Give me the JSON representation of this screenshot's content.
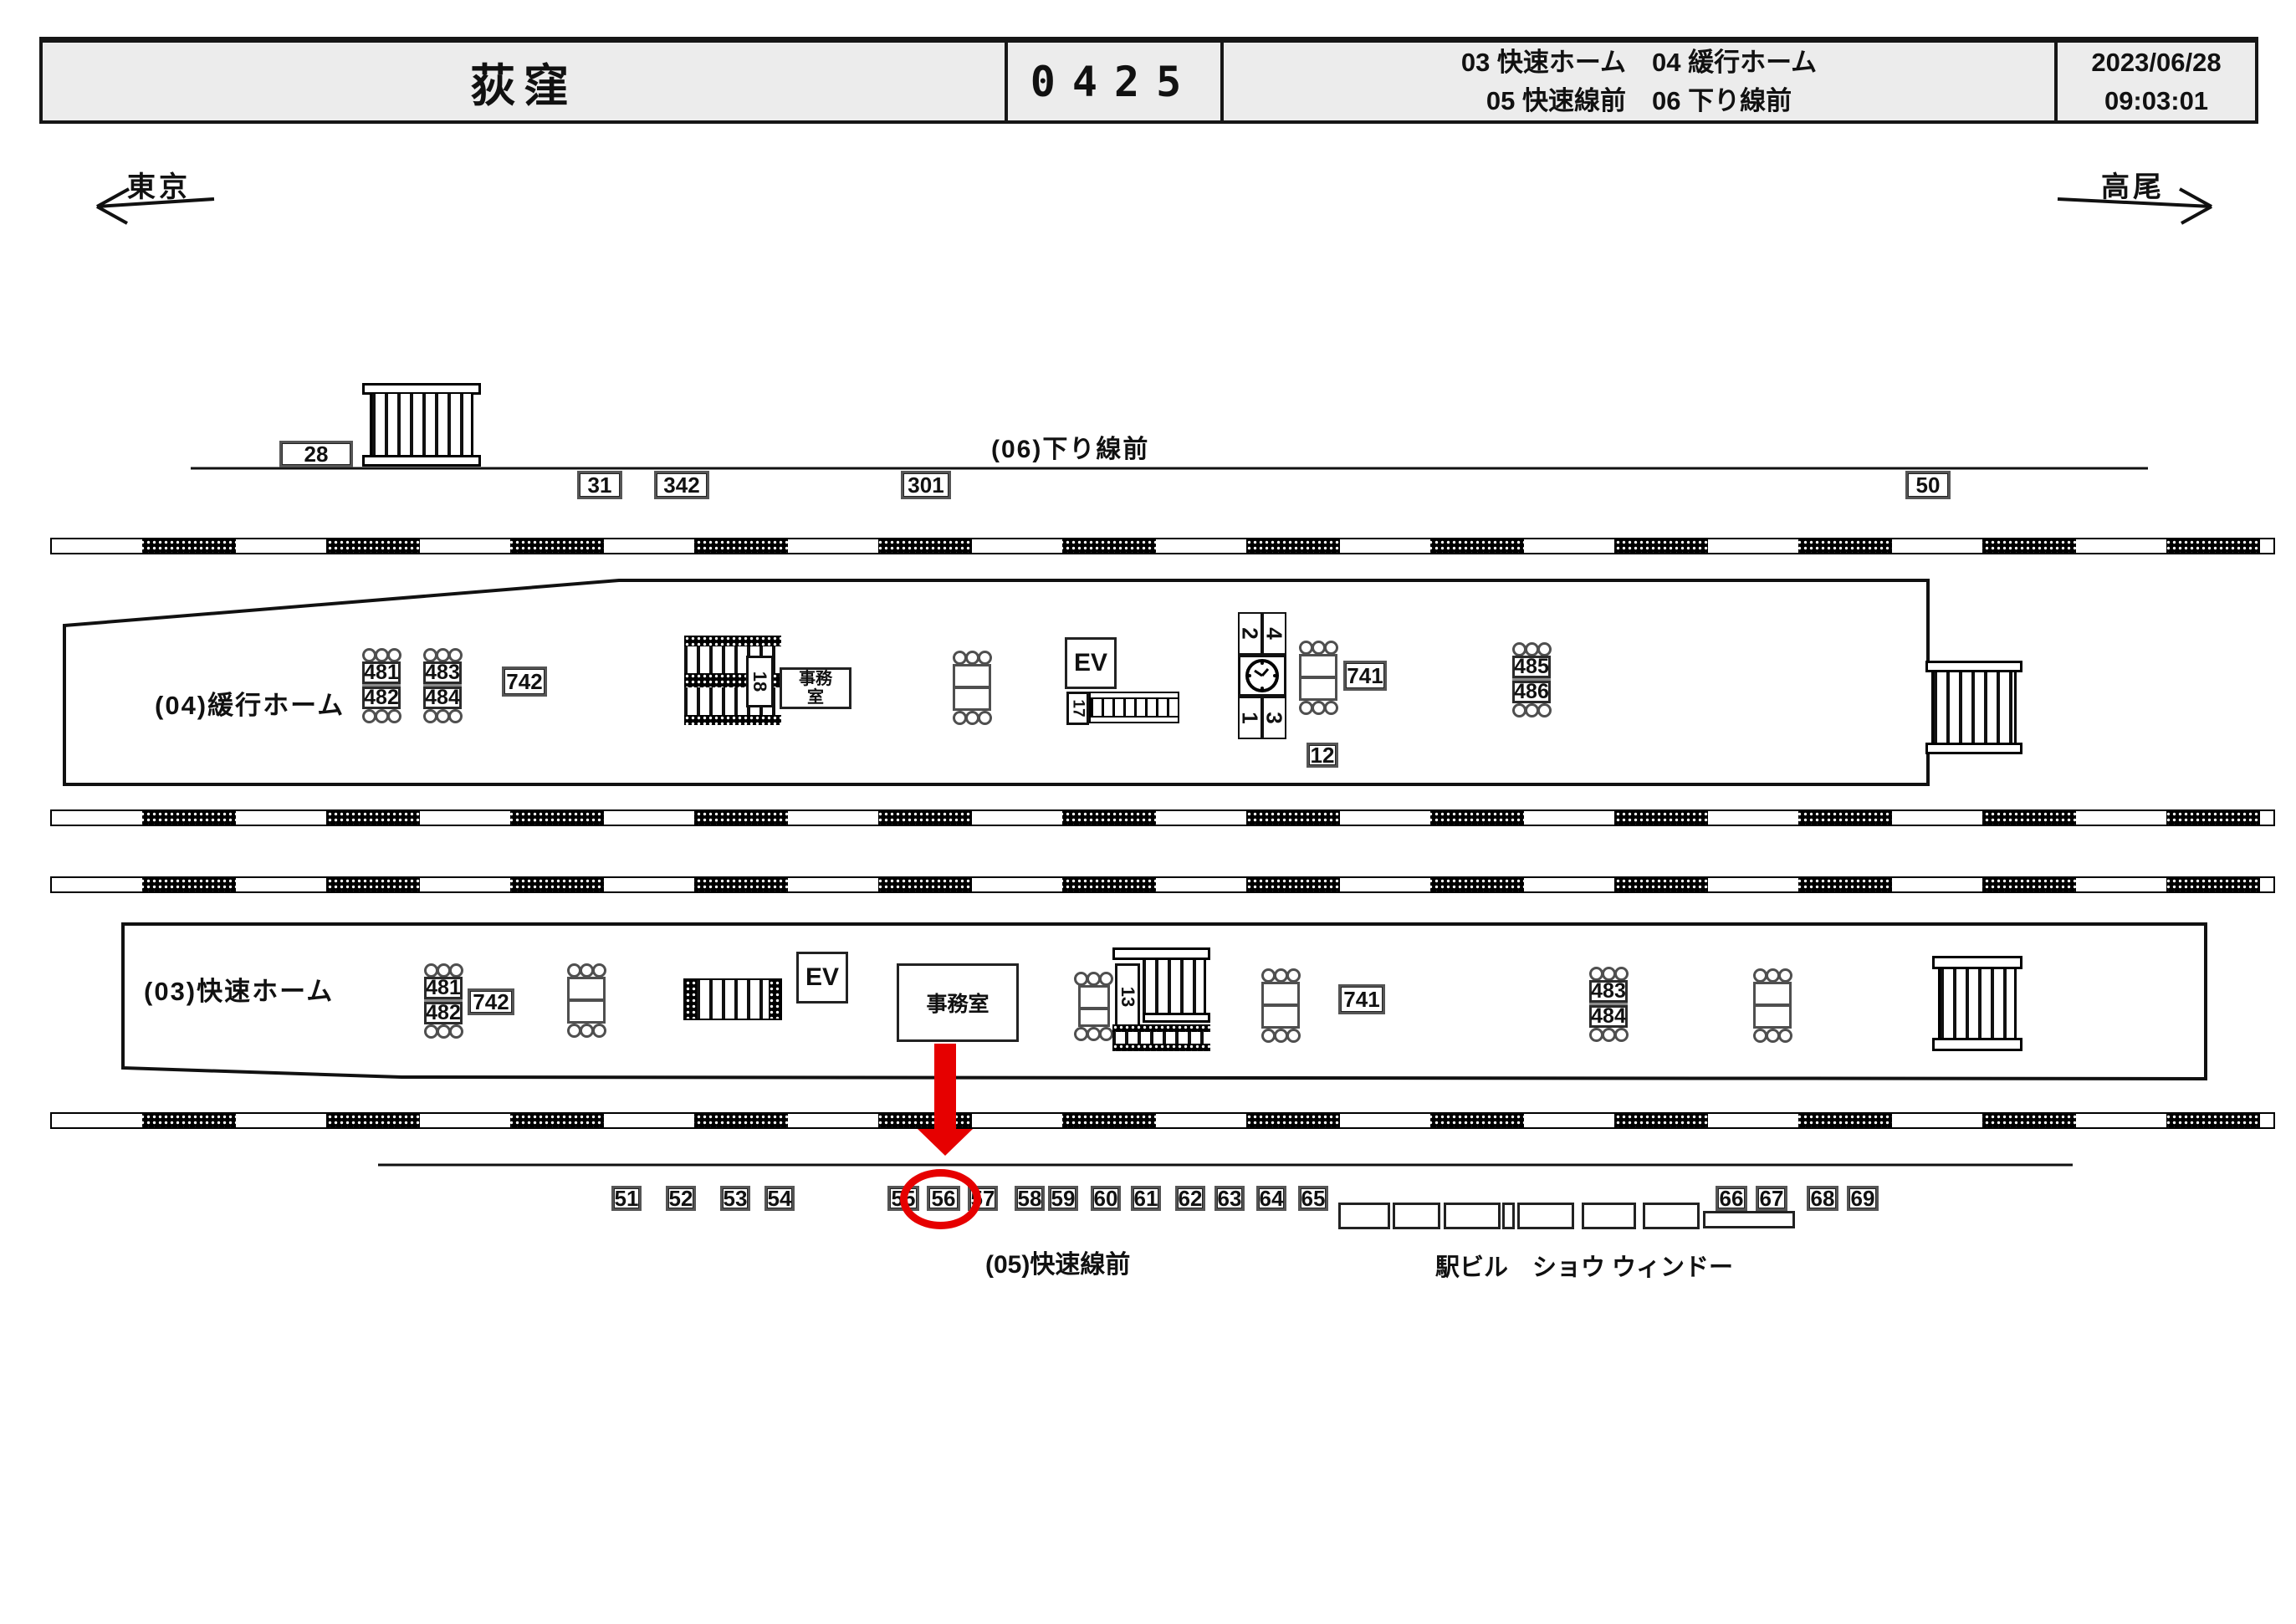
{
  "header": {
    "station_name": "荻窪",
    "station_code": "0425",
    "platform_list_1": "03 快速ホーム　04 緩行ホーム",
    "platform_list_2": "05 快速線前　06 下り線前",
    "date": "2023/06/28",
    "time": "09:03:01"
  },
  "directions": {
    "left": "東京",
    "right": "高尾"
  },
  "line06": {
    "label": "(06)下り線前",
    "box_28": "28",
    "boxes_below": [
      "31",
      "342",
      "301",
      "50"
    ]
  },
  "platform04": {
    "label": "(04)緩行ホーム",
    "benchA": [
      "481",
      "482"
    ],
    "benchB": [
      "483",
      "484"
    ],
    "benchC": [
      "485",
      "486"
    ],
    "box742": "742",
    "box741": "741",
    "box12": "12",
    "office_line1": "事務",
    "office_line2": "室",
    "ev": "EV",
    "stair18": "18",
    "esc17": "17",
    "tower": [
      "2",
      "4",
      "1",
      "3"
    ]
  },
  "platform03": {
    "label": "(03)快速ホーム",
    "benchA": [
      "481",
      "482"
    ],
    "benchB": [
      "483",
      "484"
    ],
    "box742": "742",
    "box741": "741",
    "office": "事務室",
    "ev": "EV",
    "stair13": "13"
  },
  "line05": {
    "label": "(05)快速線前",
    "boxes": [
      "51",
      "52",
      "53",
      "54",
      "55",
      "56",
      "57",
      "58",
      "59",
      "60",
      "61",
      "62",
      "63",
      "64",
      "65",
      "66",
      "67",
      "68",
      "69"
    ],
    "highlighted": "56",
    "show_window_label": "駅ビル　ショウ ウィンドー"
  },
  "colors": {
    "highlight_red": "#e60000",
    "ink": "#111111",
    "panel_bg": "#ececec"
  }
}
